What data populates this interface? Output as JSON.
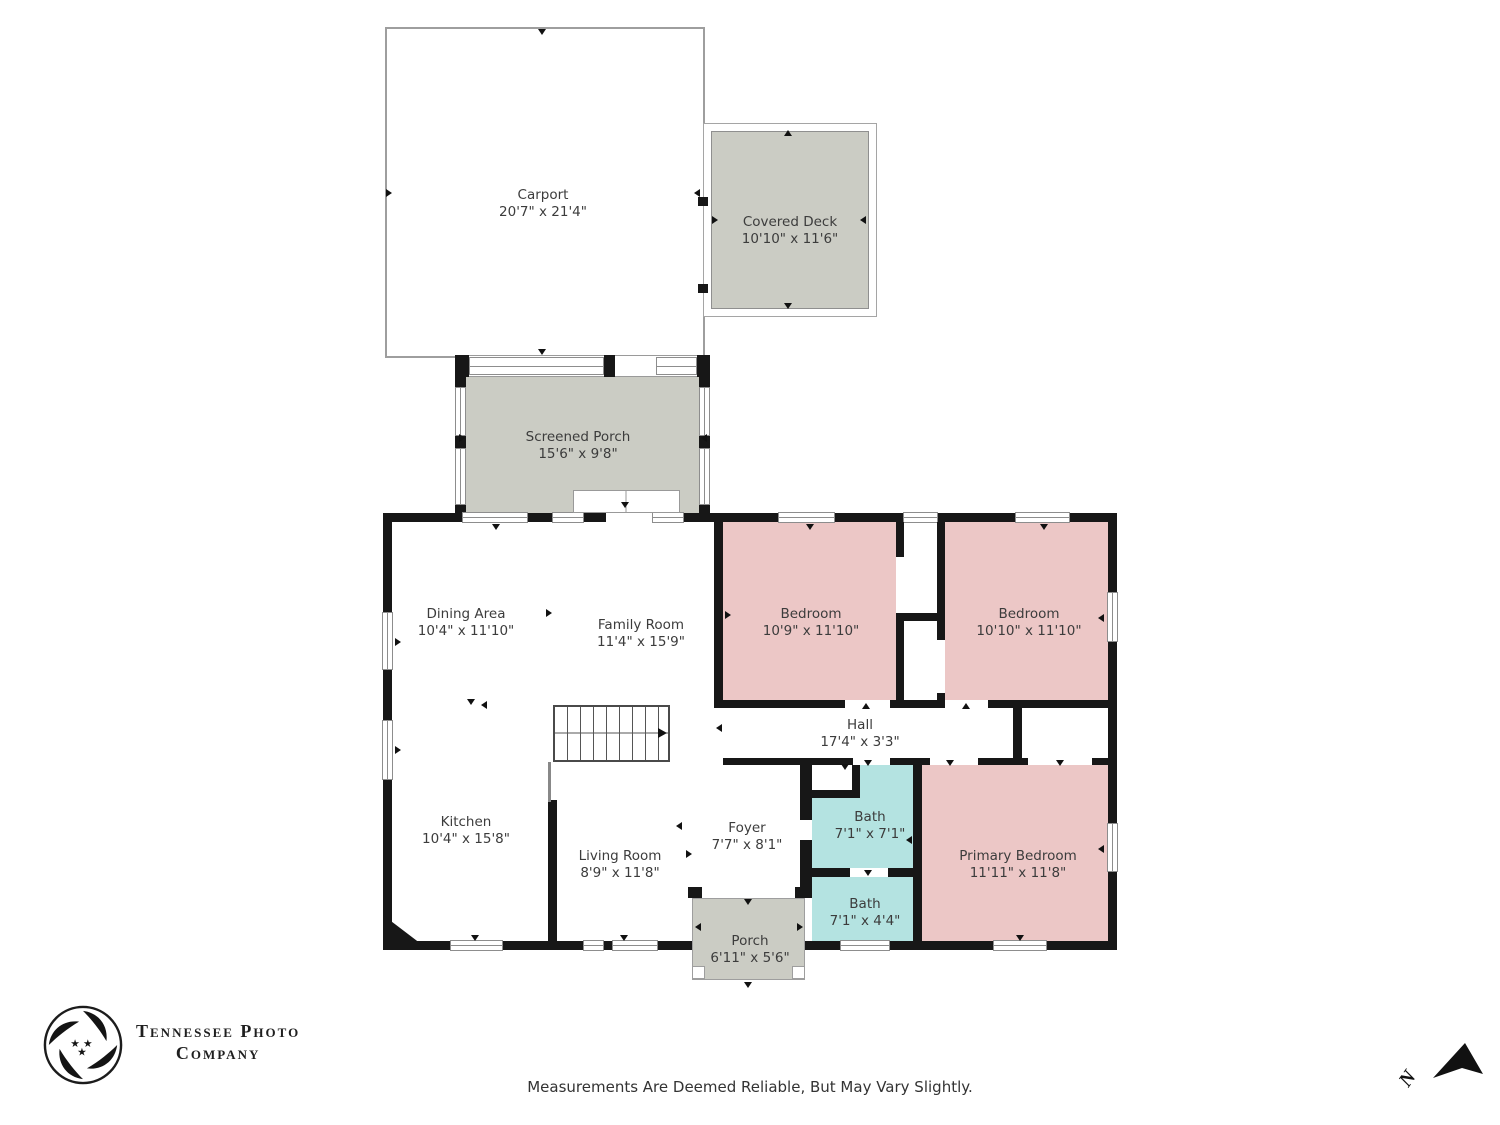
{
  "plan": {
    "rooms": [
      {
        "name": "Carport",
        "dims": "20'7\" x 21'4\""
      },
      {
        "name": "Covered Deck",
        "dims": "10'10\" x 11'6\""
      },
      {
        "name": "Screened Porch",
        "dims": "15'6\" x 9'8\""
      },
      {
        "name": "Dining Area",
        "dims": "10'4\" x 11'10\""
      },
      {
        "name": "Family Room",
        "dims": "11'4\" x 15'9\""
      },
      {
        "name": "Bedroom",
        "dims": "10'9\" x 11'10\""
      },
      {
        "name": "Bedroom",
        "dims": "10'10\" x 11'10\""
      },
      {
        "name": "Hall",
        "dims": "17'4\" x 3'3\""
      },
      {
        "name": "Kitchen",
        "dims": "10'4\" x 15'8\""
      },
      {
        "name": "Living Room",
        "dims": "8'9\" x 11'8\""
      },
      {
        "name": "Foyer",
        "dims": "7'7\" x 8'1\""
      },
      {
        "name": "Bath",
        "dims": "7'1\" x 7'1\""
      },
      {
        "name": "Bath",
        "dims": "7'1\" x 4'4\""
      },
      {
        "name": "Primary Bedroom",
        "dims": "11'11\" x 11'8\""
      },
      {
        "name": "Porch",
        "dims": "6'11\" x 5'6\""
      }
    ]
  },
  "branding": {
    "logo_line1": "Tennessee Photo",
    "logo_line2": "Company"
  },
  "footer": {
    "disclaimer": "Measurements Are Deemed Reliable, But May Vary Slightly."
  },
  "compass": {
    "label": "N"
  },
  "colors": {
    "bedroom_fill": "#ecc7c6",
    "bath_fill": "#b4e3e1",
    "porch_fill": "#cbccc4",
    "wall": "#171717"
  }
}
